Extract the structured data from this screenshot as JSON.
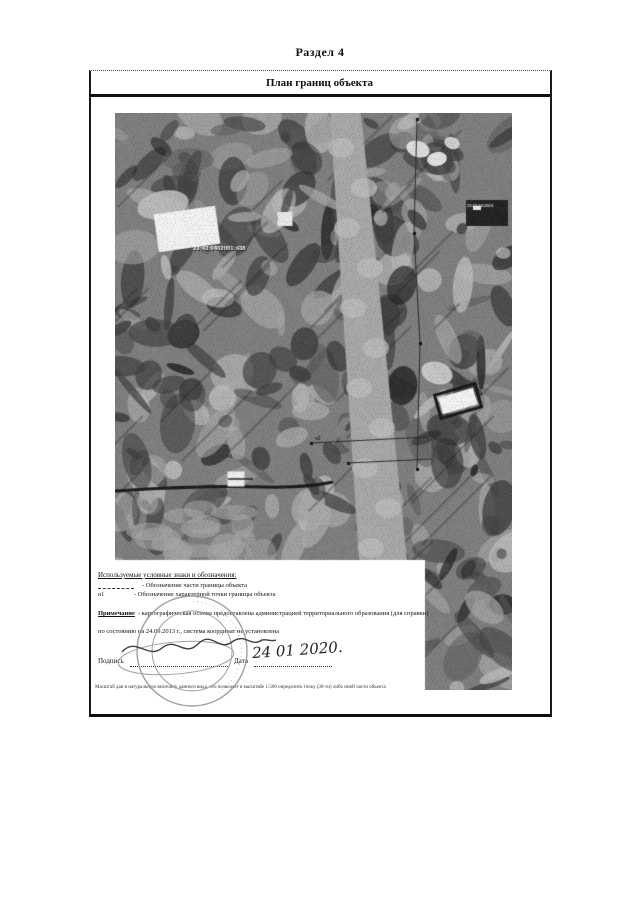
{
  "document": {
    "section_title": "Раздел 4",
    "plan_title": "План границ объекта"
  },
  "map": {
    "cadastral_label": "23:43:0402001:438",
    "secondary_label": "23:43:0402001",
    "point_labels": [
      "н1",
      "н2"
    ],
    "colors": {
      "base": "#7e7e7e",
      "dark": "#3f3f3f",
      "darker": "#232323",
      "mid": "#5a5a5a",
      "light": "#a7a7a7",
      "lighter": "#bcbcbc",
      "white": "#f1f1f1",
      "line": "#2a2a2a"
    }
  },
  "legend": {
    "heading": "Используемые условные знаки и обозначения:",
    "items": [
      {
        "symbol": "",
        "label": "- Обозначение части границы объекта"
      },
      {
        "symbol": "н1",
        "label": "- Обозначение характерной точки границы объекта"
      }
    ]
  },
  "note": {
    "term": "Примечание",
    "line1": "- картографическая основа предоставлена администрацией территориального образования (для справки)",
    "line2": "по состоянию на 24.09.2013 г., система координат не установлена"
  },
  "signature": {
    "label": "Подпись",
    "date_label": "Дата",
    "date_value": "24 01 2020."
  },
  "footnote": "Масштаб дан в натуральную величину данного вида, что позволяет в масштабе 1:500 определить точку (30-ти) либо иной части объекта",
  "stamp": {
    "ring_text": "· · · · · · · · · · · · · · · · · · · · · · · · · · · · · ·"
  }
}
